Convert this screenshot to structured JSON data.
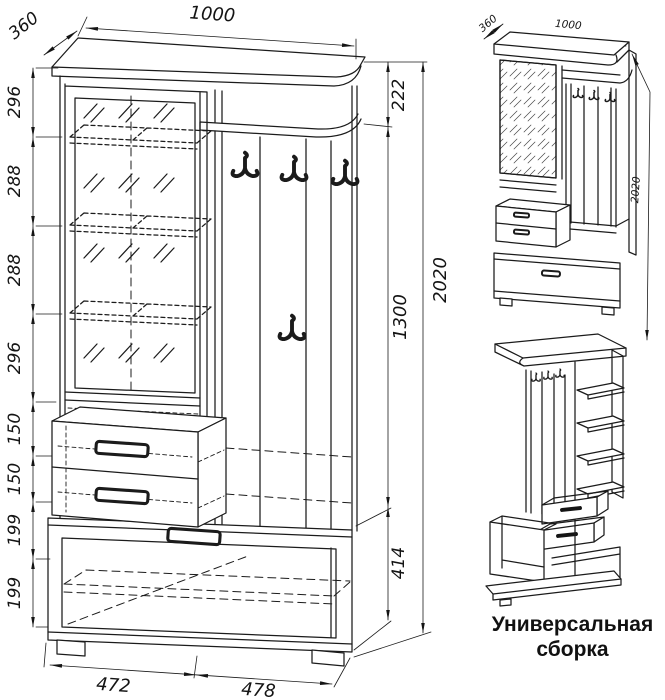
{
  "caption": {
    "line1": "Универсальная",
    "line2": "сборка"
  },
  "colors": {
    "line": "#1b1b1b",
    "background": "#ffffff",
    "text": "#141414"
  },
  "main_view": {
    "top_width": "1000",
    "top_depth": "360",
    "left_chain": [
      "296",
      "288",
      "288",
      "296",
      "150",
      "150",
      "199",
      "199"
    ],
    "right_chain": [
      "222",
      "1300",
      "414"
    ],
    "total_height": "2020",
    "bottom_widths": [
      "472",
      "478"
    ]
  },
  "assembly_view": {
    "depth": "360",
    "width": "1000",
    "height": "2020"
  }
}
